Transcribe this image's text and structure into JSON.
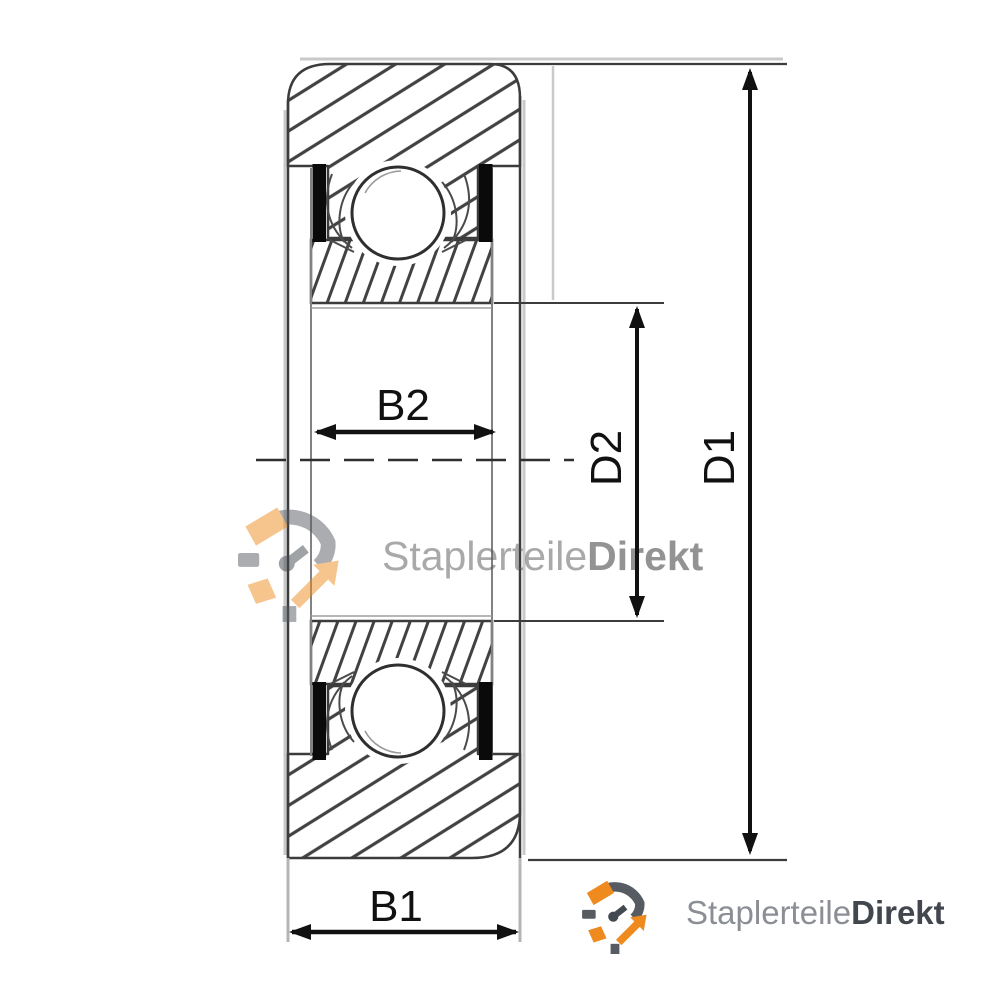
{
  "dimensions": {
    "b1": "B1",
    "b2": "B2",
    "d1": "D1",
    "d2": "D2"
  },
  "watermark": {
    "brand_regular": "Staplerteile",
    "brand_bold": "Direkt"
  },
  "footer_logo": {
    "brand_regular": "Staplerteile",
    "brand_bold": "Direkt"
  },
  "icons": {
    "logo_mark": "circular-arrows-logo-icon"
  },
  "colors": {
    "accent_orange": "#ef8a1e",
    "logo_gray": "#575c63",
    "logo_text_gray": "#8b8e94",
    "logo_text_dark": "#42474e",
    "drawing_line": "#3c3c3c",
    "dimension_black": "#111111"
  }
}
